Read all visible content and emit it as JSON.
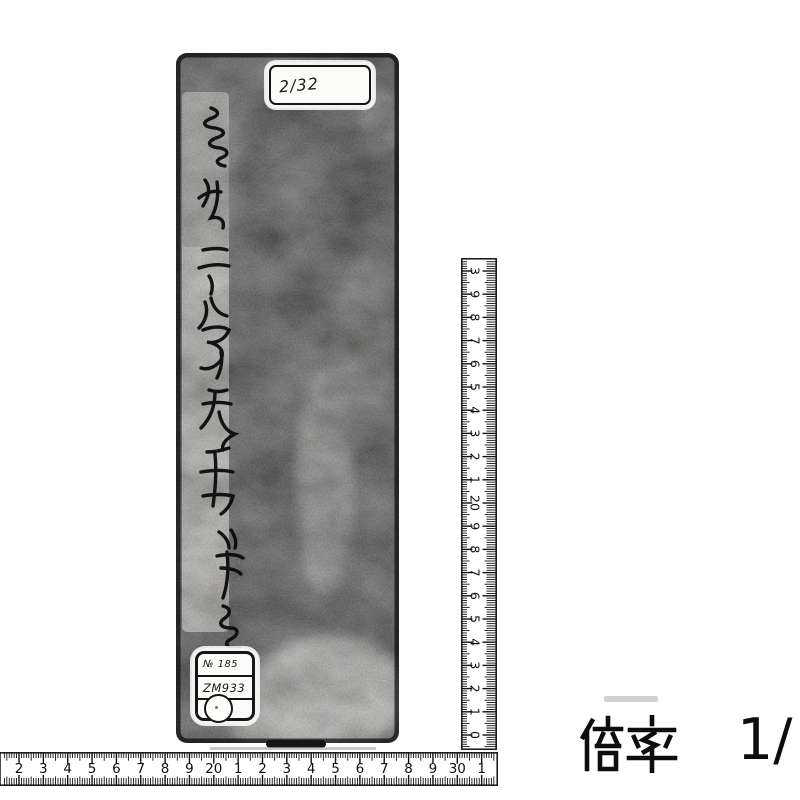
{
  "colors": {
    "paper": "#ffffff",
    "ink": "#111111",
    "cover": "#101010"
  },
  "scan": {
    "object": {
      "top_label_text": "2/32",
      "spine_calligraphy_partial": "…二峰先生筆…",
      "bottom_label_line1": "№ 185",
      "bottom_label_line2": "ZM933"
    },
    "vertical_ruler": {
      "labels_bottom_to_top": [
        "0",
        "1",
        "2",
        "3",
        "4",
        "5",
        "6",
        "7",
        "8",
        "9",
        "20",
        "1",
        "2",
        "3",
        "4",
        "5",
        "6",
        "7",
        "8",
        "9",
        "3"
      ]
    },
    "horizontal_ruler": {
      "labels_left_to_right": [
        "2",
        "3",
        "4",
        "5",
        "6",
        "7",
        "8",
        "9",
        "20",
        "1",
        "2",
        "3",
        "4",
        "5",
        "6",
        "7",
        "8",
        "9",
        "30",
        "1"
      ]
    },
    "caption": {
      "label": "倍率",
      "ratio": "1/"
    }
  }
}
